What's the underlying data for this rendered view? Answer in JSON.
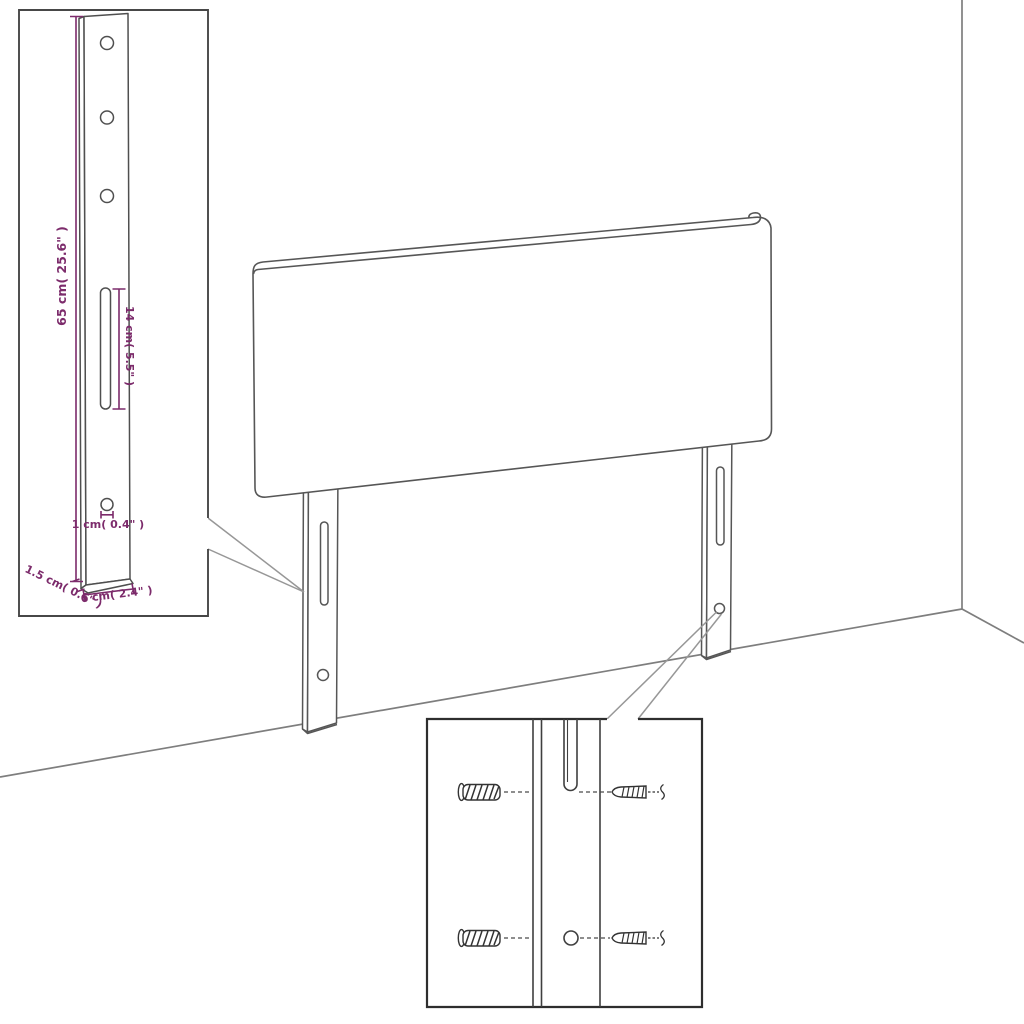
{
  "diagram": {
    "kind": "product-dimension-diagram",
    "subject": "upholstered headboard with two mounting legs, wall-corner backdrop, and two zoom insets",
    "colors": {
      "background": "#ffffff",
      "outline": "#4f4f4f",
      "room_lines": "#7e7e7e",
      "callout_lines": "#979797",
      "dimension_accent": "#7c2b6b",
      "inset_border": "#474747",
      "detail_inset_border": "#2e2e2e"
    },
    "dimensions": {
      "bracket_height": "65 cm( 25.6\" )",
      "slot_length": "14 cm( 5.5\" )",
      "hole_diameter": "1 cm( 0.4\" )",
      "bracket_thickness": "1.5 cm( 0.6\" )",
      "bracket_width": "6 cm( 2.4\" )"
    },
    "insets": {
      "bracket_inset": "close-up of mounting leg with 3 holes, long slot and lower screw hole",
      "hardware_inset": "close-up of leg slot and hole with wall plugs (left) and screws (right)"
    }
  }
}
